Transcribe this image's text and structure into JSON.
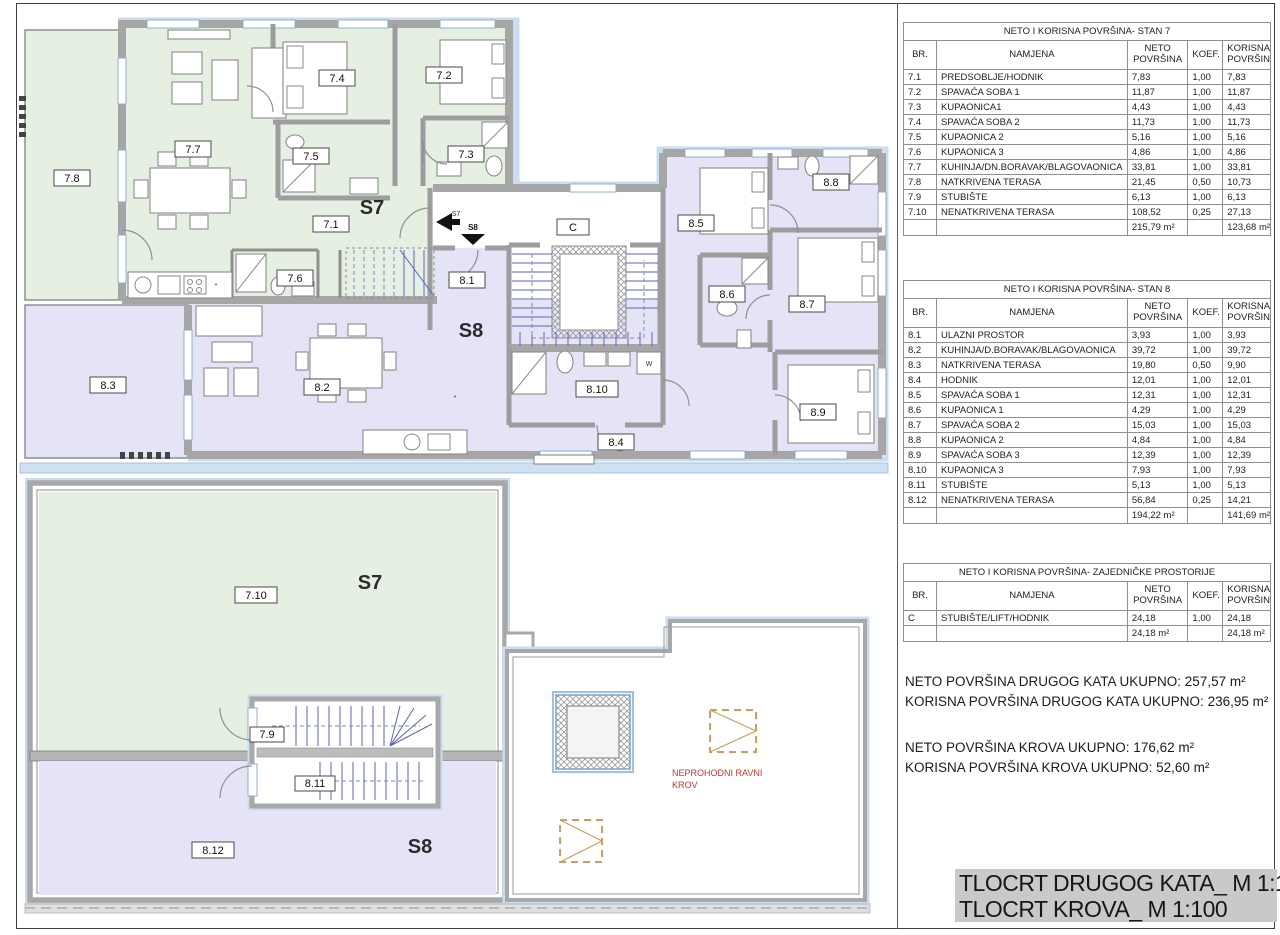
{
  "colors": {
    "s7_fill": "#e6f0e2",
    "s8_fill": "#e4e4f6",
    "wall_gray": "#a6a6a6",
    "trim_blue": "#c9ddf1",
    "stair_blue": "#5b63c2",
    "note_red": "#c0392b",
    "roof_hatch_orange": "#cf9c5a",
    "title_bg": "#c9c9c9"
  },
  "plan": {
    "upper": {
      "r78": "7.8",
      "r77": "7.7",
      "r74": "7.4",
      "r72": "7.2",
      "r75": "7.5",
      "r73": "7.3",
      "r71": "7.1",
      "r76": "7.6",
      "s7": "S7",
      "c": "C",
      "r81": "8.1",
      "s8": "S8",
      "r85": "8.5",
      "r88": "8.8",
      "r86": "8.6",
      "r87": "8.7",
      "r89": "8.9",
      "r810": "8.10",
      "r84": "8.4",
      "r83": "8.3",
      "r82": "8.2",
      "entry_s7": "S7",
      "entry_s8": "S8",
      "washer": "W",
      "asterisk": "*"
    },
    "roof": {
      "r710": "7.10",
      "s7": "S7",
      "r79": "7.9",
      "r811": "8.11",
      "r812": "8.12",
      "s8": "S8",
      "note_line1": "NEPROHODNI RAVNI",
      "note_line2": "KROV"
    }
  },
  "tables": [
    {
      "title": "NETO I KORISNA POVRŠINA- STAN 7",
      "headers": [
        "BR.",
        "NAMJENA",
        "NETO POVRŠINA",
        "KOEF.",
        "KORISNA POVRŠINA"
      ],
      "rows": [
        [
          "7.1",
          "PREDSOBLJE/HODNIK",
          "7,83",
          "1,00",
          "7,83"
        ],
        [
          "7.2",
          "SPAVAĆA SOBA 1",
          "11,87",
          "1,00",
          "11,87"
        ],
        [
          "7.3",
          "KUPAONICA1",
          "4,43",
          "1,00",
          "4,43"
        ],
        [
          "7.4",
          "SPAVAĆA SOBA 2",
          "11,73",
          "1,00",
          "11,73"
        ],
        [
          "7.5",
          "KUPAONICA 2",
          "5,16",
          "1,00",
          "5,16"
        ],
        [
          "7.6",
          "KUPAONICA 3",
          "4,86",
          "1,00",
          "4,86"
        ],
        [
          "7.7",
          "KUHINJA/DN.BORAVAK/BLAGOVAONICA",
          "33,81",
          "1,00",
          "33,81"
        ],
        [
          "7.8",
          "NATKRIVENA TERASA",
          "21,45",
          "0,50",
          "10,73"
        ],
        [
          "7.9",
          "STUBIŠTE",
          "6,13",
          "1,00",
          "6,13"
        ],
        [
          "7.10",
          "NENATKRIVENA TERASA",
          "108,52",
          "0,25",
          "27,13"
        ]
      ],
      "total_neto": "215,79 m²",
      "total_korisna": "123,68 m²"
    },
    {
      "title": "NETO I KORISNA POVRŠINA- STAN 8",
      "headers": [
        "BR.",
        "NAMJENA",
        "NETO POVRŠINA",
        "KOEF.",
        "KORISNA POVRŠINA"
      ],
      "rows": [
        [
          "8.1",
          "ULAZNI PROSTOR",
          "3,93",
          "1,00",
          "3,93"
        ],
        [
          "8.2",
          "KUHINJA/D.BORAVAK/BLAGOVAONICA",
          "39,72",
          "1,00",
          "39,72"
        ],
        [
          "8.3",
          "NATKRIVENA TERASA",
          "19,80",
          "0,50",
          "9,90"
        ],
        [
          "8.4",
          "HODNIK",
          "12,01",
          "1,00",
          "12,01"
        ],
        [
          "8.5",
          "SPAVAĆA SOBA 1",
          "12,31",
          "1,00",
          "12,31"
        ],
        [
          "8.6",
          "KUPAONICA 1",
          "4,29",
          "1,00",
          "4,29"
        ],
        [
          "8.7",
          "SPAVAĆA SOBA 2",
          "15,03",
          "1,00",
          "15,03"
        ],
        [
          "8.8",
          "KUPAONICA 2",
          "4,84",
          "1,00",
          "4,84"
        ],
        [
          "8.9",
          "SPAVAĆA SOBA 3",
          "12,39",
          "1,00",
          "12,39"
        ],
        [
          "8.10",
          "KUPAONICA 3",
          "7,93",
          "1,00",
          "7,93"
        ],
        [
          "8.11",
          "STUBIŠTE",
          "5,13",
          "1,00",
          "5,13"
        ],
        [
          "8.12",
          "NENATKRIVENA TERASA",
          "56,84",
          "0,25",
          "14,21"
        ]
      ],
      "total_neto": "194,22 m²",
      "total_korisna": "141,69 m²"
    },
    {
      "title": "NETO I KORISNA POVRŠINA- ZAJEDNIČKE PROSTORIJE",
      "headers": [
        "BR.",
        "NAMJENA",
        "NETO POVRŠINA",
        "KOEF.",
        "KORISNA POVRŠINA"
      ],
      "rows": [
        [
          "C",
          "STUBIŠTE/LIFT/HODNIK",
          "24,18",
          "1,00",
          "24,18"
        ]
      ],
      "total_neto": "24,18 m²",
      "total_korisna": "24,18 m²"
    }
  ],
  "summary": {
    "line1": "NETO POVRŠINA DRUGOG KATA UKUPNO: 257,57 m²",
    "line2": "KORISNA POVRŠINA DRUGOG KATA UKUPNO: 236,95 m²",
    "line3": "NETO POVRŠINA KROVA UKUPNO: 176,62 m²",
    "line4": "KORISNA POVRŠINA KROVA UKUPNO: 52,60 m²"
  },
  "title_block": {
    "line1": "TLOCRT DRUGOG KATA_ M 1:100",
    "line2": "TLOCRT KROVA_ M 1:100"
  }
}
